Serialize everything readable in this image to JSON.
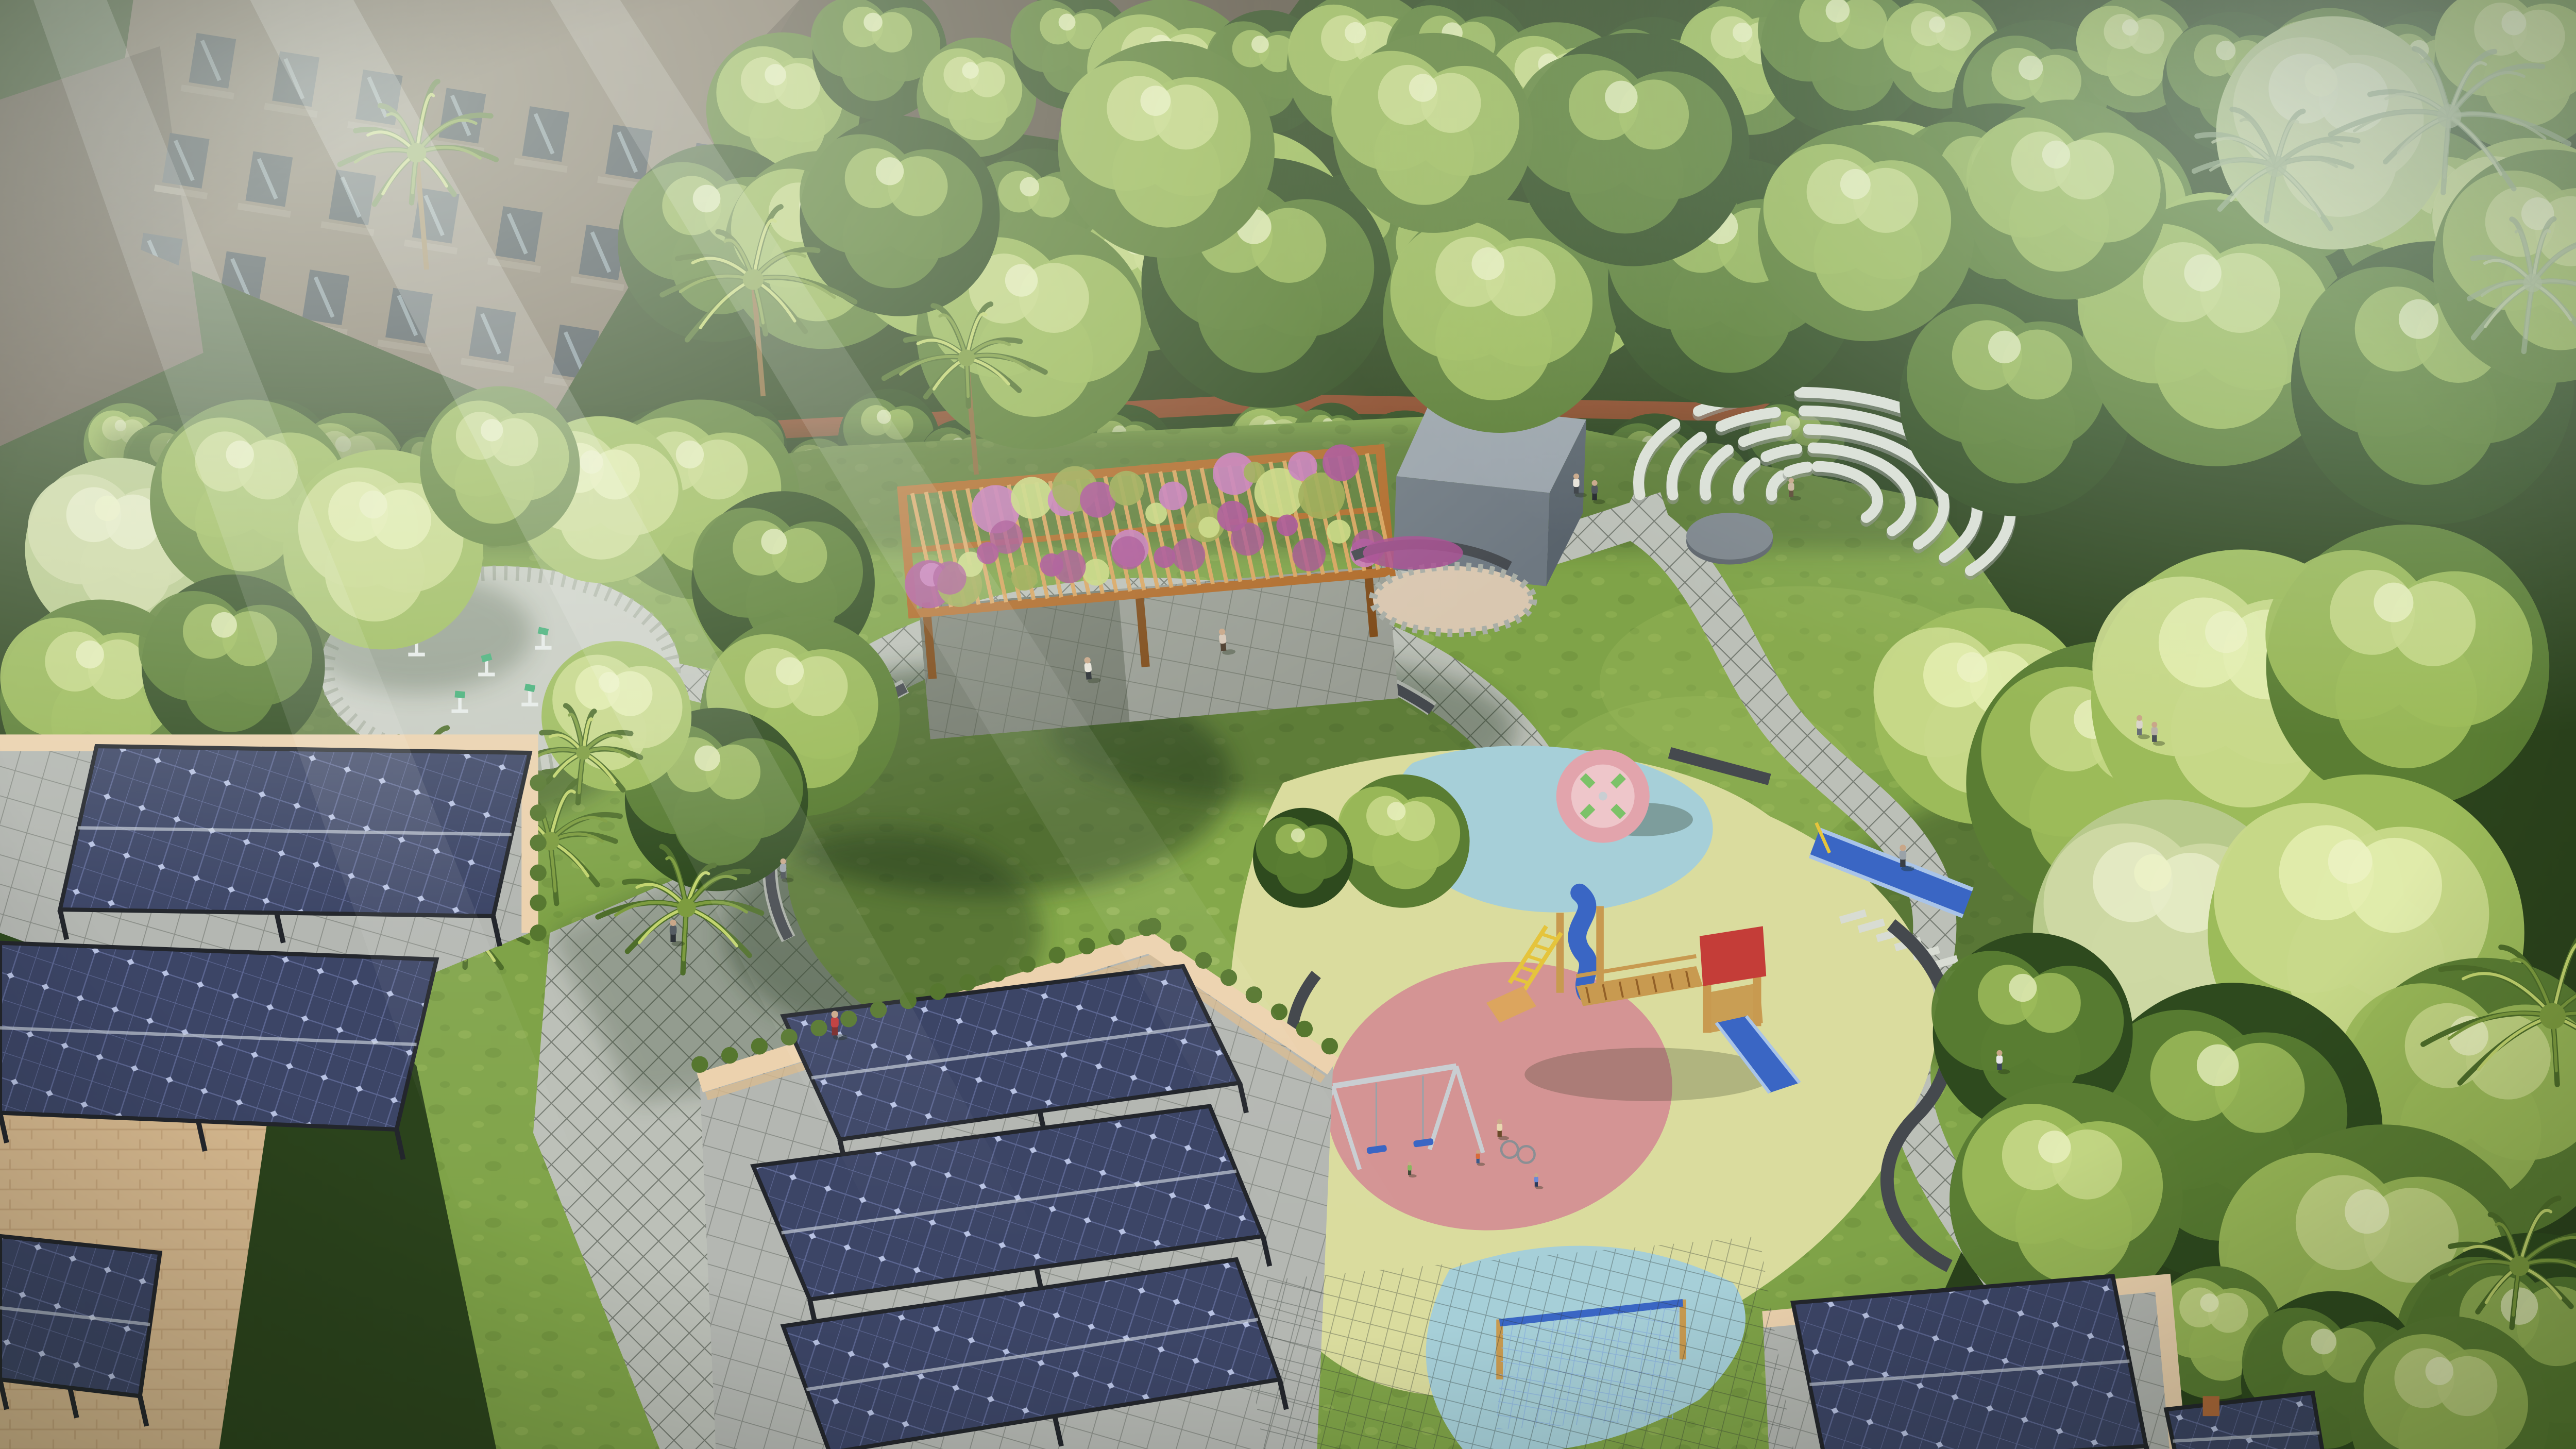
{
  "scene": {
    "type": "3d-architectural-aerial-render",
    "subject": "residential amenity park with circular lawn, flowered pergola, stone amphitheater, playground, outdoor gym and rooftop solar canopies"
  },
  "colors": {
    "forest_dark": "#2b431c",
    "tree_dark": "#2e4a1e",
    "tree_mid": "#5a7d33",
    "tree_light": "#9cbb5a",
    "tree_sun": "#c8d98a",
    "tree_pale": "#b7c98b",
    "palm_dark": "#4e6e2a",
    "palm_mid": "#7d9c3f",
    "palm_light": "#c2d46e",
    "grass_base": "#7fa348",
    "grass_light": "#a3c060",
    "grass_dark": "#5d7f33",
    "lawn_base": "#84a84a",
    "lawn_light": "#b2c873",
    "shadow_green": "#24381a",
    "path_tile": "#bcc0b8",
    "path_joint": "#757b72",
    "roof_tile": "#b4b7b2",
    "roof_joint": "#8b8f89",
    "stone_light": "#d8dcd3",
    "bench_dark": "#45494e",
    "bench_stone": "#a9aea6",
    "wood": "#b06a28",
    "wood_light": "#dca55e",
    "wood_dark": "#7e4a18",
    "flower_purple": "#a84e92",
    "flower_pink": "#c77ab8",
    "flower_green": "#9aa84e",
    "flower_lime": "#c9d880",
    "cube_top": "#9aa3ab",
    "cube_front": "#6e7881",
    "cube_side": "#59636c",
    "sand": "#d9c7b0",
    "rust_wall": "#9a492a",
    "dark_wall": "#4a4f46",
    "amphi_arc": "#dde1d8",
    "stage_gray": "#7e868d",
    "play_yellow": "#dadc9e",
    "play_blue": "#a6cfd8",
    "play_pink": "#d49494",
    "slide_blue": "#3a66c4",
    "slide_rail": "#a9c4e8",
    "play_wood": "#c89a50",
    "play_red": "#c43d38",
    "ladder_yellow": "#e5c43c",
    "swing_frame": "#c9ced2",
    "merry_pink": "#e2a4ac",
    "merry_inner": "#eec6ca",
    "merry_green": "#7cc268",
    "net_rope": "#8fb6dc",
    "gravel": "#c7cbc2",
    "gravel_edge": "#979e8d",
    "gym_green": "#3fae76",
    "gym_white": "#e8ecea",
    "gazebo": "#e9e5da",
    "parapet": "#ecd2ae",
    "parapet_side": "#d8ba90",
    "brick_line": "#c9a87e",
    "solar_panel": "#3c4566",
    "solar_grid": "#5b6590",
    "solar_sparkle": "#c4cdee",
    "solar_frame": "#23262c",
    "hedge": "#56772f",
    "facade": "#7d7060",
    "facade_dark": "#5e5346",
    "window_dark": "#39424a",
    "window_glass": "#9fb4c0",
    "balcony": "#8d8171",
    "mesh": "#2c3430",
    "skin": "#c9a789"
  },
  "counts": {
    "amphitheater_seat_rows": 5,
    "pergola_slats": 34,
    "lawn_perimeter_benches": 7,
    "solar_canopies": 8,
    "swing_seats": 2,
    "people_visible": 16
  }
}
